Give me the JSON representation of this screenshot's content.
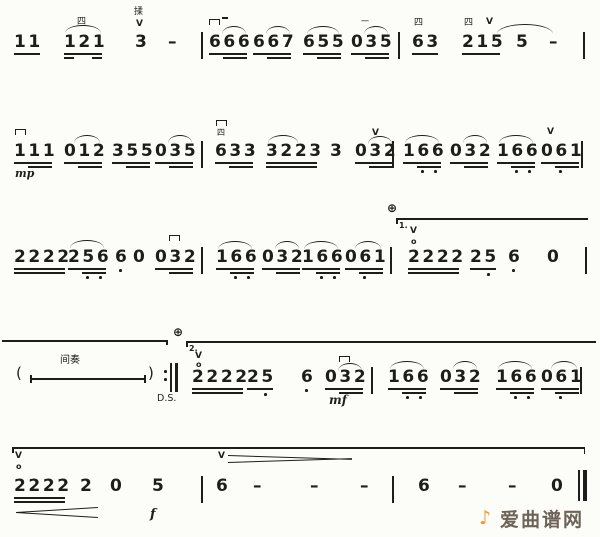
{
  "colors": {
    "ink": "#1d1d1b",
    "paper": "#fcfcf9",
    "watermark_orange": "#f0982e",
    "watermark_gray": "#6e6358"
  },
  "marks": {
    "finger_four": "四",
    "finger_one": "一",
    "vibrato": "揉",
    "up_bow": "V",
    "open_string": "o",
    "coda": "⊕",
    "volta_1": "1.",
    "volta_2": "2.",
    "interlude": "间奏",
    "dal_segno": "D.S.",
    "mp": "mp",
    "mf": "mf",
    "f": "f",
    "paren_left": "(",
    "paren_right": ")"
  },
  "lines": [
    {
      "tokens": [
        "11",
        "121",
        "3",
        "–",
        "666",
        "667",
        "655",
        "035",
        "63",
        "215",
        "5",
        "–"
      ]
    },
    {
      "tokens": [
        "111",
        "012",
        "355",
        "035",
        "633",
        "3223",
        "3",
        "032",
        "166",
        "032",
        "166",
        "061"
      ]
    },
    {
      "tokens": [
        "2222",
        "256",
        "6",
        "0",
        "032",
        "166",
        "032",
        "166",
        "061",
        "2222",
        "25",
        "6",
        "0"
      ]
    },
    {
      "tokens": [
        "2222",
        "25",
        "6",
        "032",
        "166",
        "032",
        "166",
        "061"
      ]
    },
    {
      "tokens": [
        "2222",
        "2",
        "0",
        "5",
        "6",
        "–",
        "–",
        "–",
        "6",
        "–",
        "–",
        "0"
      ]
    }
  ],
  "watermark": {
    "icon": "♪",
    "text": "爱曲谱网"
  }
}
